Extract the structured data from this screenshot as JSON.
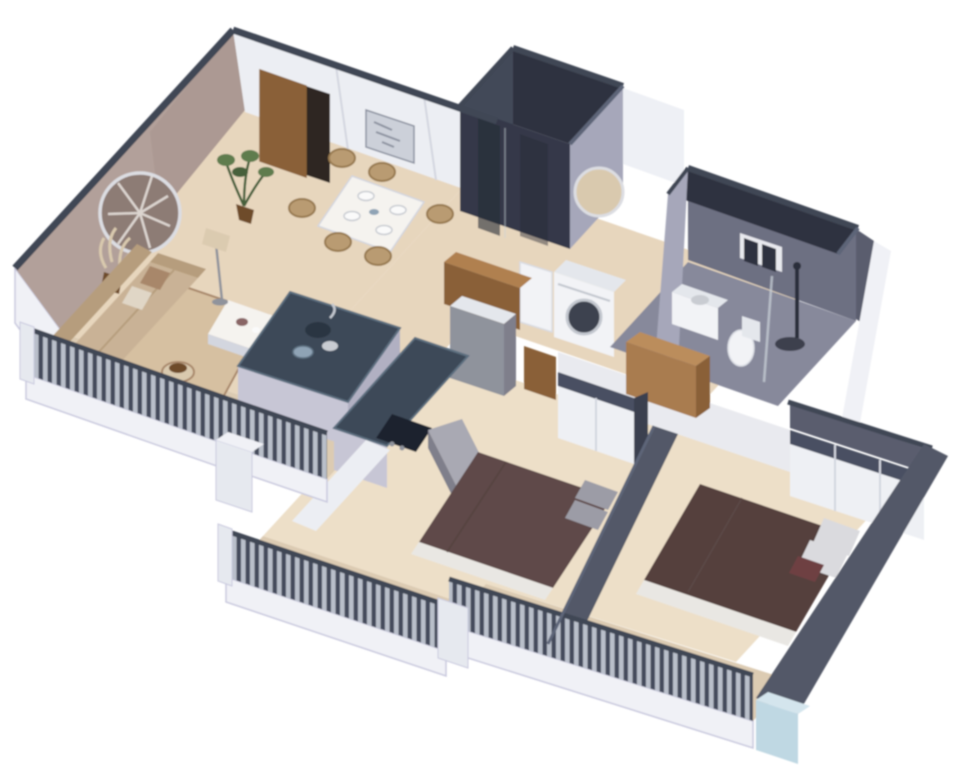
{
  "scene": {
    "type": "isometric-3d-apartment-floor-plan-render",
    "view": "cutaway top-down 3d render, white background, no visible text",
    "rooms": [
      {
        "id": "living-room",
        "items": [
          "mauve-accent-wall",
          "round-feather-wall-mirror",
          "pampas-decor",
          "sofa",
          "throw-pillows",
          "area-rug",
          "coffee-table",
          "floor-lamp",
          "round-planter",
          "potted-plant",
          "open-entry-door",
          "wall-art-frame"
        ]
      },
      {
        "id": "dining-area",
        "items": [
          "dining-table",
          "six-wicker-chairs",
          "four-place-settings"
        ]
      },
      {
        "id": "kitchen",
        "items": [
          "island-with-navy-counter",
          "tv-panel-on-island",
          "sink-and-faucet",
          "bowls",
          "back-counter",
          "cooktop",
          "lavender-cabinets",
          "refrigerator-box",
          "wood-top-console"
        ]
      },
      {
        "id": "shower-room",
        "items": [
          "dark-tiled-walls",
          "glass-shower",
          "round-mirror-on-light-wall",
          "white-cabinet",
          "washing-machine"
        ]
      },
      {
        "id": "bathroom",
        "items": [
          "gray-tiled-walls",
          "double-pane-window",
          "vanity-with-sink",
          "toilet",
          "shower-fixture",
          "glass-partition"
        ]
      },
      {
        "id": "bedroom-1",
        "items": [
          "double-bed-maroon-duvet",
          "gray-pillows",
          "white-wardrobe-dark-frame",
          "gray-dresser",
          "wood-door"
        ]
      },
      {
        "id": "bedroom-2",
        "items": [
          "double-bed-brown-duvet",
          "light-pillows",
          "maroon-accent-pillow",
          "white-sliding-wardrobe",
          "wood-partition"
        ]
      },
      {
        "id": "balconies",
        "items": [
          "living-balcony",
          "kitchen-balcony",
          "bedroom-1-balcony",
          "bedroom-2-balcony",
          "dark-slatted-railings",
          "white-corner-pillars",
          "light-blue-corner-post"
        ]
      }
    ]
  },
  "palette": {
    "bg": "#ffffff",
    "edge_dark": "#3f4655",
    "edge_mid": "#5d6578",
    "wall_white": "#eceef3",
    "wall_seam": "#d3d6df",
    "wall_mauve": "#b2a09a",
    "wall_mauve_deep": "#a18d87",
    "mirror_ring": "#dcdde2",
    "mirror_face": "#8d7b75",
    "feather_light": "#e9e4df",
    "skirt_white": "#f0f1f6",
    "outline_lavender": "#c9c9de",
    "door_wood": "#8a6138",
    "door_gap": "#2e2520",
    "art_frame": "#ccd0d9",
    "art_line": "#8b919f",
    "floor_beige": "#e7d6bd",
    "floor_beige_light": "#eddfc8",
    "rug": "#d6c0a1",
    "sofa": "#c9b296",
    "sofa_shade": "#b69d7d",
    "pillow_accent": "#a8876a",
    "pillow_light": "#e0d6c6",
    "table_white": "#f5f3ef",
    "chair_wicker": "#b99b72",
    "chair_wicker_dark": "#97794f",
    "plate_white": "#fafafa",
    "plate_rim": "#c9ccd2",
    "lamp_shade": "#dbcbb0",
    "metal_gray": "#8f939c",
    "plant_green": "#5f7c4d",
    "plant_green_dark": "#46603a",
    "pot_brown": "#6e4c2a",
    "planter_beige": "#d9c9ae",
    "island_top": "#3c4a59",
    "island_rim": "#5d6f80",
    "tv_black": "#17171d",
    "cabinet_lav": "#c7c6d5",
    "cabinet_lav_dark": "#b1b0c2",
    "cooktop_black": "#1d242e",
    "sink_dark": "#2b3642",
    "bowl_blue": "#8fa3b5",
    "counter_wood": "#b08050",
    "counter_wood_dark": "#8a6138",
    "appliance_white": "#f2f3f6",
    "appliance_shade": "#d9dce3",
    "appliance_top": "#e4e7ec",
    "washer_door": "#3c4350",
    "washer_ring": "#c3c7cf",
    "bath1_dark": "#424959",
    "bath1_darker": "#343949",
    "bath1_roof": "#2e3340",
    "bath1_streak": "#272b36",
    "bath_wall_light": "#a6a7ba",
    "bath2_wall": "#6d7082",
    "bath2_wall_dark": "#5a5d6e",
    "bath2_floor": "#87899b",
    "window_frame": "#e8e9ee",
    "window_pane": "#2e3340",
    "glass_line": "#ccd3da",
    "wardrobe_white": "#eef0f4",
    "wardrobe_frame": "#495062",
    "wardrobe_side": "#3a4150",
    "bed1": "#5e4a49",
    "bed2": "#55413e",
    "sheet_white": "#e9e7e3",
    "pillow_gray": "#9c9ca6",
    "pillow_white": "#dadade",
    "pillow_maroon": "#6e4142",
    "dresser_top": "#a9a9b3",
    "dresser_front": "#7f7f8b",
    "dresser_side": "#8e8e99",
    "divider_wall": "#525868",
    "band_white": "#e9eaef",
    "wood_part": "#a97c4f",
    "wood_part_top": "#bb8d5c",
    "wood_part_side": "#8a6138",
    "railing_base": "#b9bfca",
    "railing_bar": "#454c5b",
    "rail_top": "#3f4655",
    "post_light": "#e6e9ef",
    "post_blue": "#bfd8e3",
    "post_blue_top": "#d4e5ed",
    "balcony_floor": "#dccbb2",
    "wall_between": "#eef0f5",
    "toilet_white": "#f2f3f6",
    "shower_dark": "#2b2f3a"
  }
}
